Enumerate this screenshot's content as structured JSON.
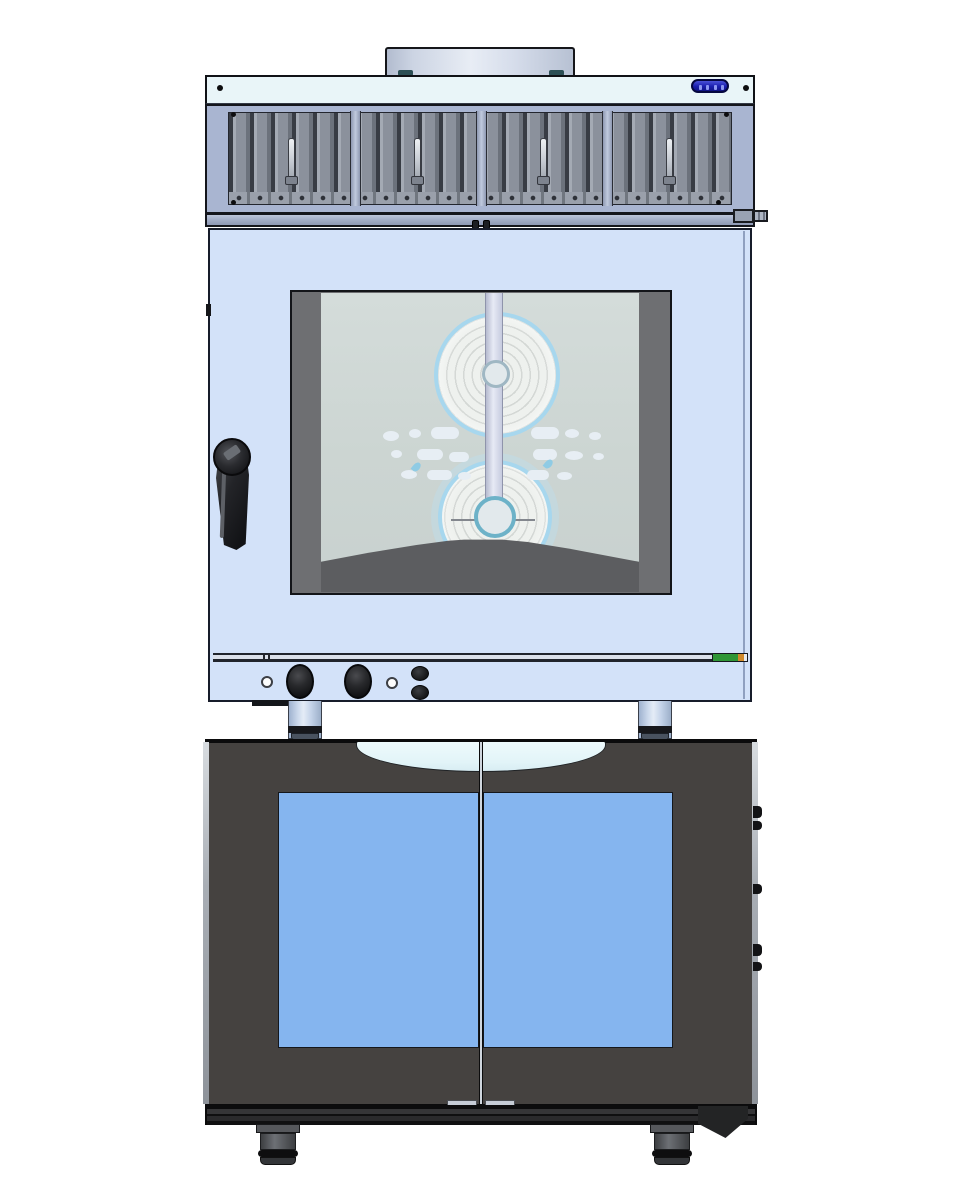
{
  "machine": {
    "title": "Stacked combi oven unit - front elevation CAD render",
    "view": "front elevation",
    "sections": {
      "hood": {
        "label": "Condensation hood",
        "components": "flue collar, status display, louvered filter panel, 4 filter pull handles, right drain fitting",
        "filter_handles": 4
      },
      "oven": {
        "label": "Combi oven",
        "components": "glass door, left latch handle, 2 fan wheels, center steam duct, interior deflector",
        "fan_wheels": 2
      },
      "stand": {
        "label": "Support legs",
        "count": 2
      },
      "cabinet": {
        "label": "Base cabinet with double glass doors",
        "components": "recessed top handle, 2 blue glass door panels, right hinge knobs, 2 feet, right bracket",
        "doors": 2,
        "feet": 2
      }
    },
    "controls": {
      "label": "Oven control strip",
      "indicator_lamps": 2,
      "rotary_knobs": 2,
      "push_buttons": 2,
      "rating_label": "green-orange rating sticker"
    }
  },
  "colors": {
    "background": "#ffffff",
    "oven_body": "#d3e2f9",
    "hood_frame": "#a9b5d1",
    "hood_top_band": "#e9f5f8",
    "louver_slats": "#8b919c",
    "glass_interior": "#ccd5d2",
    "fan_rim": "#a7d7ee",
    "cabinet_body": "#454240",
    "cabinet_glass": "#85b5ef",
    "display_blue": "#1d22b4",
    "label_green": "#2f9636",
    "label_orange": "#d08a2c",
    "hardware_black": "#1a1b1e"
  }
}
